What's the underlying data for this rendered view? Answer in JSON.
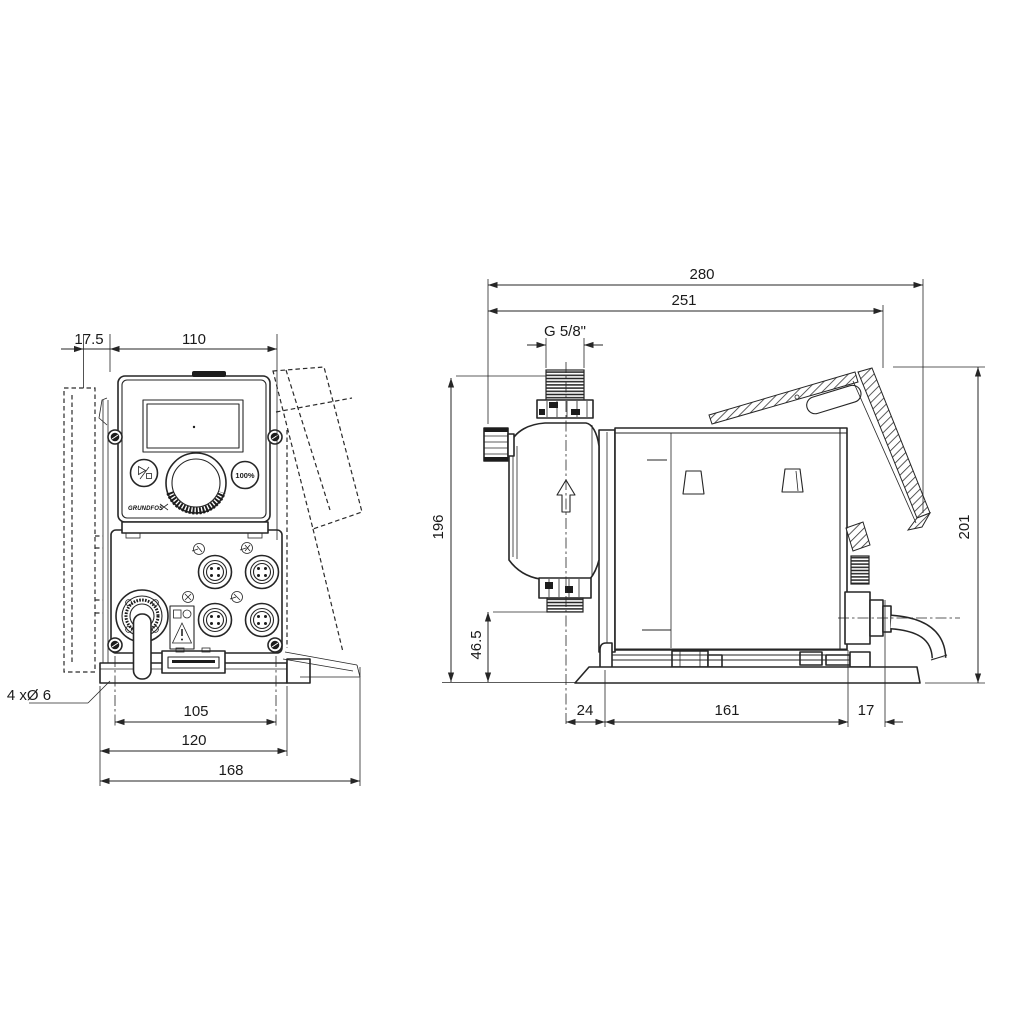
{
  "front_view": {
    "dim_offset": "17.5",
    "dim_width": "110",
    "dim_hole_spacing": "105",
    "dim_plate_width": "120",
    "dim_total_width": "168",
    "dim_holes": "4 xØ 6",
    "button_percent": "100%",
    "logo": "GRUNDFOS"
  },
  "side_view": {
    "dim_total_depth": "280",
    "dim_depth": "251",
    "dim_thread": "G 5/8\"",
    "dim_height": "196",
    "dim_outlet_height": "46.5",
    "dim_bracket_height": "201",
    "dim_head_offset": "24",
    "dim_base_length": "161",
    "dim_cable_offset": "17"
  },
  "colors": {
    "line": "#262626",
    "background": "#ffffff"
  }
}
